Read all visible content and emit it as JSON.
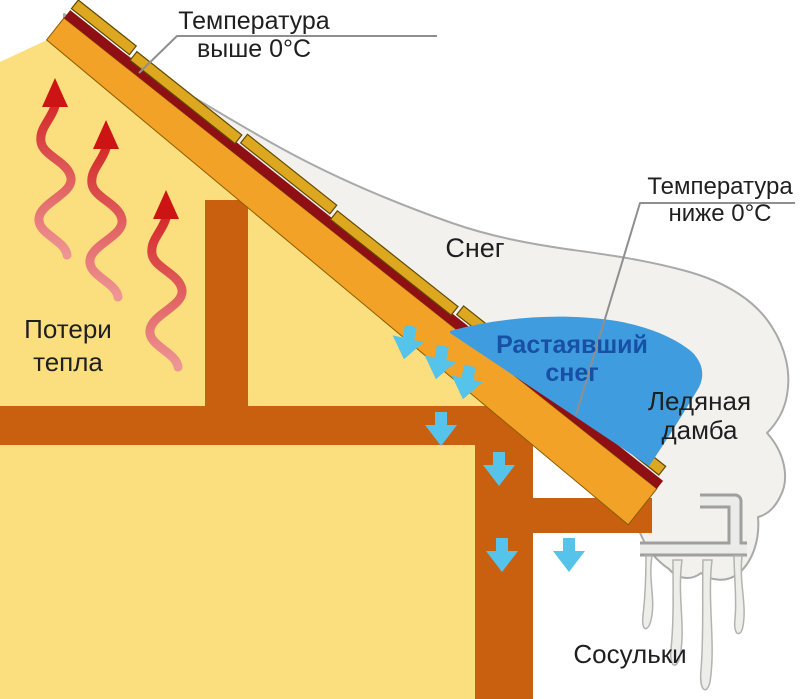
{
  "colors": {
    "bg": "#ffffff",
    "wall": "#fbdf7e",
    "deck": "#f2a227",
    "beam": "#c8600f",
    "membrane": "#8e1014",
    "batten": "#dda71f",
    "batten_outline": "#5f4a00",
    "snow": "#f2f1ee",
    "snow_outline": "#a9a9a9",
    "water": "#3f9cdf",
    "drip_arrow": "#56c3ea",
    "heat_top": "#d42a2a",
    "heat_bottom": "#ee9595",
    "heat_head": "#cc1414",
    "gutter_outer": "#9f9f9f",
    "gutter_inner": "#ebebe9",
    "icicle_fill": "#ededea",
    "icicle_outline": "#b3b3b0",
    "leader": "#8f8f8f",
    "text_dark": "#1f1f1f",
    "text_blue": "#1750a4"
  },
  "labels": {
    "temp_above": {
      "line1": "Температура",
      "line2": "выше 0°С"
    },
    "temp_below": {
      "line1": "Температура",
      "line2": "ниже 0°С"
    },
    "snow": "Снег",
    "melted_snow": {
      "line1": "Растаявший",
      "line2": "снег"
    },
    "ice_dam": {
      "line1": "Ледяная",
      "line2": "дамба"
    },
    "heat_loss": {
      "line1": "Потери",
      "line2": "тепла"
    },
    "icicles": "Сосульки"
  },
  "icons": {
    "heat_flow": "red-wavy-up-arrow",
    "melt_drip": "blue-down-arrow",
    "gutter": "gutter-hook-profile"
  }
}
